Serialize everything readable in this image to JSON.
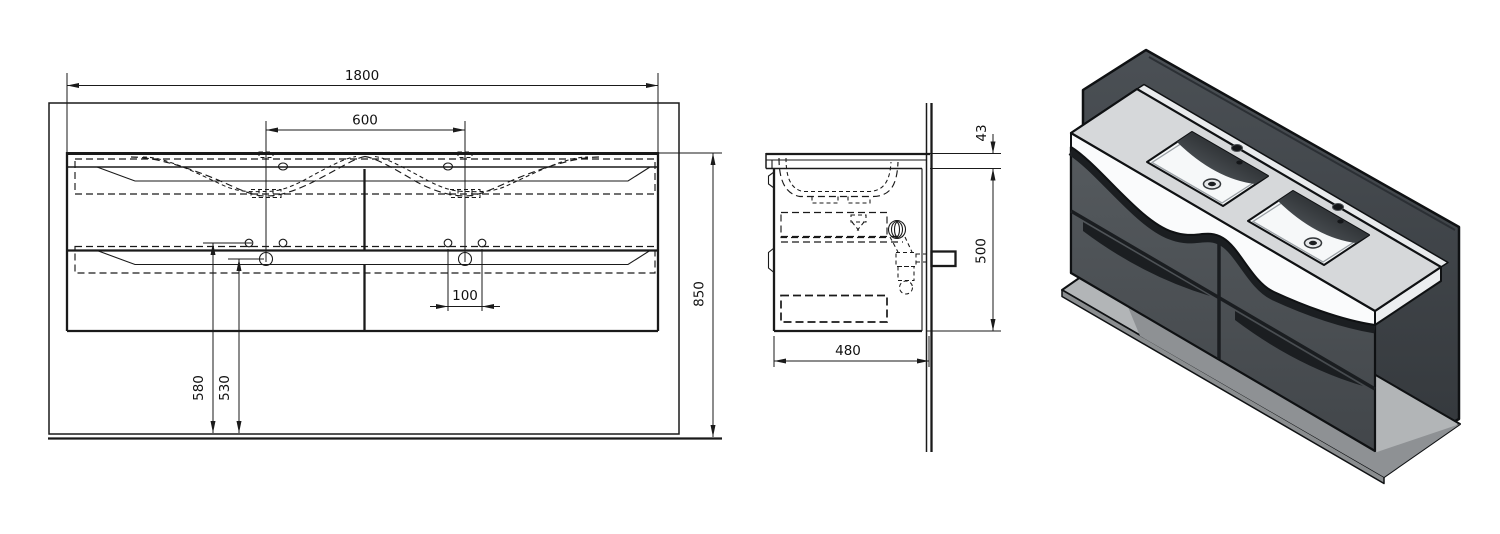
{
  "drawing": {
    "title": "double-washbasin-vanity-technical-drawing",
    "front_view": {
      "name": "front view",
      "dims": {
        "overall_width": "1800",
        "basin_spacing": "600",
        "hole_spacing": "100",
        "hole_height_a": "580",
        "hole_height_b": "530",
        "mounting_height": "850"
      }
    },
    "side_view": {
      "name": "side view",
      "dims": {
        "top_thickness": "43",
        "body_height": "500",
        "depth": "480"
      }
    },
    "iso_view": {
      "name": "isometric render"
    },
    "colors": {
      "line": "#1a1a1a",
      "backdrop_panel": "#43474c",
      "floor_plate": "#b2b5b7",
      "floor_shadow": "#8e9194",
      "cabinet_front": "#4b5054",
      "cabinet_end": "#5e6266",
      "groove_dark": "#1b1e21",
      "ceramic_top": "#d6d8da",
      "ceramic_white": "#fafbfc",
      "bowl_shadow_dark": "#101214"
    }
  }
}
